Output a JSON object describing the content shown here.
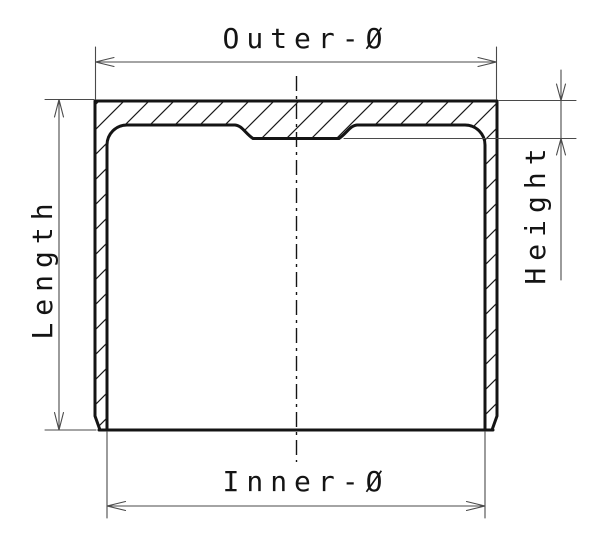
{
  "drawing": {
    "type": "technical-section-drawing",
    "part": "cup-shaped cylindrical component cross-section (hatched)",
    "labels": {
      "outer_diameter": "Outer-Ø",
      "inner_diameter": "Inner-Ø",
      "length": "Length",
      "height": "Height"
    },
    "colors": {
      "outline": "#141414",
      "dimension_lines": "#4a4a4a",
      "background": "#ffffff"
    }
  }
}
